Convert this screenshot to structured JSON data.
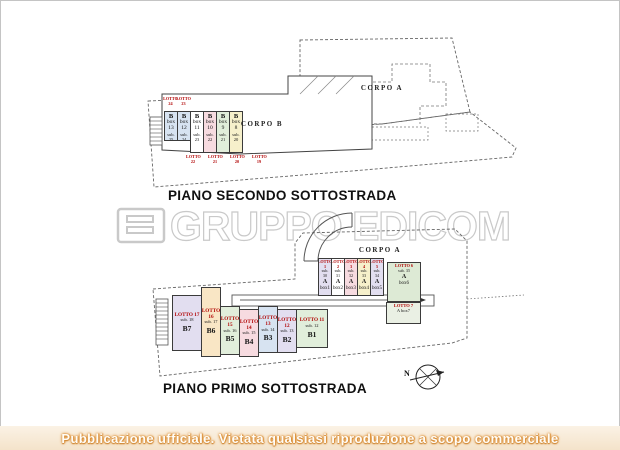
{
  "watermark": {
    "text": "GRUPPO EDICOM"
  },
  "banner": {
    "text": "Pubblicazione ufficiale. Vietata qualsiasi riproduzione a scopo commerciale"
  },
  "palette": {
    "blue": "#d7e3f1",
    "lavender": "#e2def0",
    "pink": "#f7dbe0",
    "green": "#e1eedb",
    "yellow": "#f6f0cb",
    "peach": "#f9e6c5",
    "white": "#ffffff",
    "box_green": "#ddead5",
    "lot_red": "#b00000",
    "banner_orange": "#dd8f35",
    "watermark_gray": "#c9c9c9",
    "line": "#555555"
  },
  "plan_secondo": {
    "title": "PIANO SECONDO SOTTOSTRADA",
    "corpo_a": "CORPO A",
    "corpo_b": "CORPO B",
    "lotto_above": [
      "LOTTO 24",
      "LOTTO 23"
    ],
    "lotto_below": [
      "LOTTO 22",
      "LOTTO 21",
      "LOTTO 20",
      "LOTTO 19"
    ],
    "boxes": [
      {
        "letter": "B",
        "box": "box 13",
        "sub": "sub. 25"
      },
      {
        "letter": "B",
        "box": "box 12",
        "sub": "sub. 24"
      },
      {
        "letter": "B",
        "box": "box 11",
        "sub": "sub. 23"
      },
      {
        "letter": "B",
        "box": "box 10",
        "sub": "sub. 22"
      },
      {
        "letter": "B",
        "box": "box 9",
        "sub": "sub. 21"
      },
      {
        "letter": "B",
        "box": "box 8",
        "sub": "sub. 20"
      }
    ]
  },
  "plan_primo": {
    "title": "PIANO PRIMO SOTTOSTRADA",
    "corpo_a": "CORPO A",
    "a_boxes": [
      {
        "lotto": "LOTTO 1",
        "sub": "sub. 30",
        "letter": "A",
        "box": "box1"
      },
      {
        "lotto": "LOTTO 2",
        "sub": "sub. 31",
        "letter": "A",
        "box": "box2"
      },
      {
        "lotto": "LOTTO 3",
        "sub": "sub. 32",
        "letter": "A",
        "box": "box3"
      },
      {
        "lotto": "LOTTO 4",
        "sub": "sub. 33",
        "letter": "A",
        "box": "box4"
      },
      {
        "lotto": "LOTTO 5",
        "sub": "sub. 34",
        "letter": "A",
        "box": "box5"
      }
    ],
    "lotto6": {
      "lotto": "LOTTO 6",
      "sub": "sub. 35",
      "letter": "A",
      "box": "box6"
    },
    "lotto7": {
      "lotto": "LOTTO 7",
      "unit": "A box7"
    },
    "b_lots": [
      {
        "lotto": "LOTTO 17",
        "sub": "sub. 18",
        "name": "B7"
      },
      {
        "lotto": "LOTTO 16",
        "sub": "sub. 17",
        "name": "B6"
      },
      {
        "lotto": "LOTTO 15",
        "sub": "sub. 16",
        "name": "B5"
      },
      {
        "lotto": "LOTTO 14",
        "sub": "sub. 15",
        "name": "B4"
      },
      {
        "lotto": "LOTTO 13",
        "sub": "sub. 14",
        "name": "B3"
      },
      {
        "lotto": "LOTTO 12",
        "sub": "sub. 13",
        "name": "B2"
      },
      {
        "lotto": "LOTTO 11",
        "sub": "sub. 12",
        "name": "B1"
      }
    ],
    "compass": "N"
  }
}
